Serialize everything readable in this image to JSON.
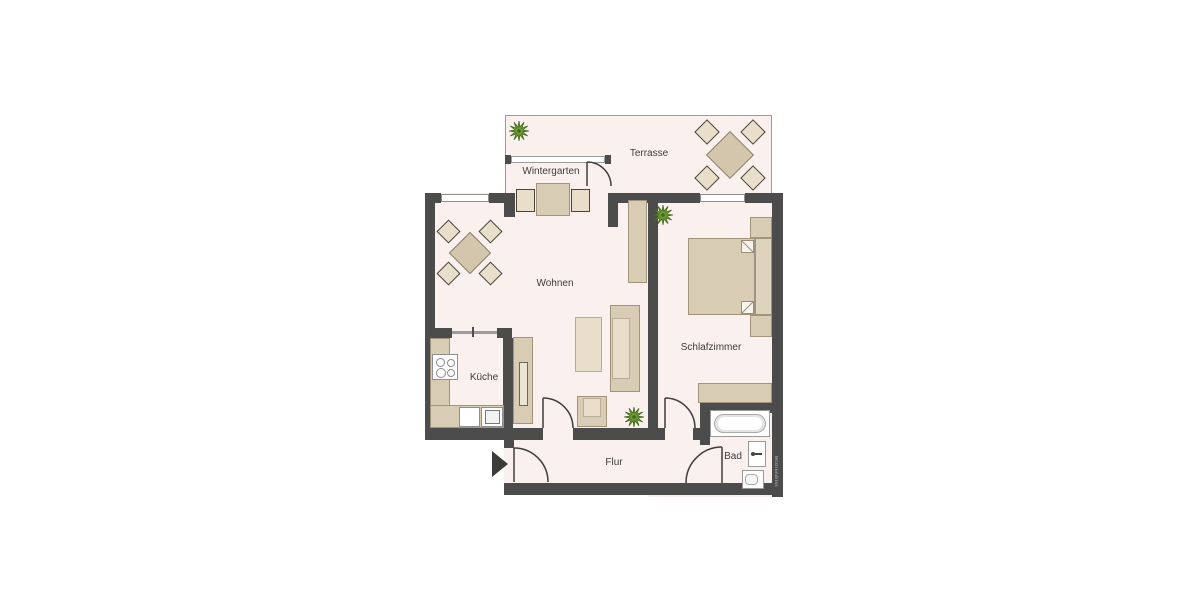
{
  "rooms": {
    "terrasse": {
      "label": "Terrasse"
    },
    "wintergarten": {
      "label": "Wintergarten"
    },
    "wohnen": {
      "label": "Wohnen"
    },
    "kueche": {
      "label": "Küche"
    },
    "schlafzimmer": {
      "label": "Schlafzimmer"
    },
    "flur": {
      "label": "Flur"
    },
    "bad": {
      "label": "Bad"
    }
  },
  "watermark": {
    "label": "McGrundriss"
  },
  "colors": {
    "wall": "#4c4c4c",
    "floor": "#faf0ee",
    "furniture": "#d8ccb5",
    "furniture-light": "#e8dec9",
    "furniture-border": "#a2947c",
    "chair-border": "#4a4339",
    "line": "#9b9b9b",
    "door": "#3e3e3e",
    "plant": "#6f9d33",
    "plant-dark": "#42691e",
    "text": "#3d3d3d"
  }
}
